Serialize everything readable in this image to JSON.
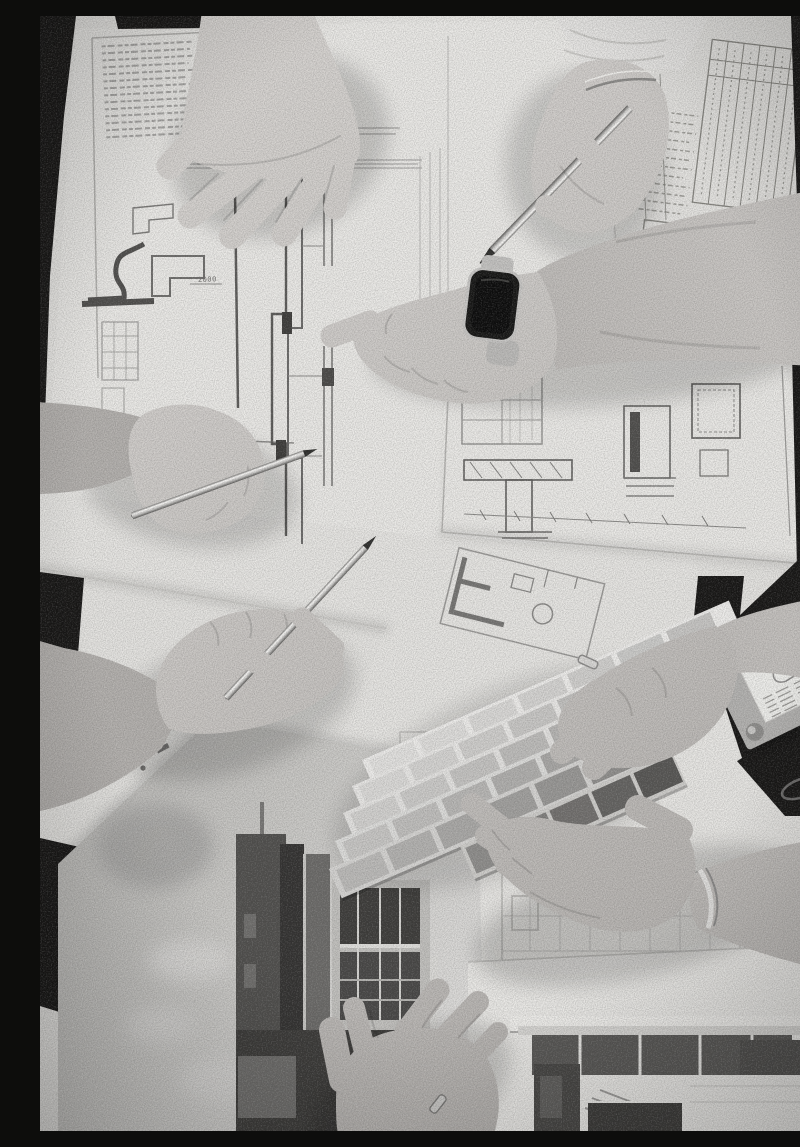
{
  "scene": {
    "type": "black-and-white overhead photograph",
    "description": "Top-down black-and-white photo of a design team meeting: several people's hands reach over a table covered with architectural blueprints and detail drawings. One hand presses a sheet flat, two hands hold silver pens, a forearm with a smartwatch points at a detail, and two hands at the right hold an open fan deck of paint swatches above building renderings.",
    "blueprints": {
      "dimension_label": "2000"
    },
    "palette": {
      "table_dark": "#151413",
      "paper_base": "#e8e7e4",
      "paper_bright": "#f1f0ed",
      "ink_dark": "#4e4d4b",
      "ink_mid": "#8a8987",
      "skin_light": "#d8d5d2",
      "skin_shadow": "#a8a5a2",
      "watch_screen": "#0c0c0c",
      "watch_case": "#c9c8c6",
      "pen_silver": "#e9e8e6",
      "sky_gray": "#c3c2bf",
      "building_dark": "#343331",
      "swatch_light": "#dedddb",
      "swatch_dark": "#5e5d5b"
    },
    "elements": [
      {
        "name": "blueprint-sheets",
        "label": "Blueprint and detail-drawing sheets covering the table"
      },
      {
        "name": "hand-top-left",
        "label": "Spread hand pressing a blueprint flat"
      },
      {
        "name": "hand-top-pen",
        "label": "Hand with bracelet holding a silver pen, sleeve at top edge"
      },
      {
        "name": "arm-smartwatch",
        "label": "Forearm with smartwatch ending in a fist pointing at a detail"
      },
      {
        "name": "hand-left-pen",
        "label": "Hand from the left holding a silver pen"
      },
      {
        "name": "hand-lower-left-pen",
        "label": "Hand from lower left writing with a silver pen"
      },
      {
        "name": "hand-swatch-ring",
        "label": "Hand with ring gripping the paint swatch fan"
      },
      {
        "name": "hand-swatch-cupped",
        "label": "Cupped hand supporting the swatch fan, arm with bracelet"
      },
      {
        "name": "hand-bottom-ring",
        "label": "Hand with ring resting on a rendering at the bottom"
      },
      {
        "name": "paint-swatch-fan",
        "label": "Fanned paint-sample deck, light to dark strips"
      },
      {
        "name": "material-sample-card",
        "label": "Gray sample card with white label and metal fastener"
      },
      {
        "name": "rendering-left",
        "label": "Photomontage rendering: dark modern building against a gray sky"
      },
      {
        "name": "rendering-right",
        "label": "Elevation rendering of a flat-roofed modern house"
      },
      {
        "name": "smartwatch",
        "label": "Smartwatch with black rectangular screen"
      },
      {
        "name": "pens",
        "label": "Three silver pens"
      },
      {
        "name": "table",
        "label": "Dark table surface visible at corners and edges"
      }
    ]
  }
}
